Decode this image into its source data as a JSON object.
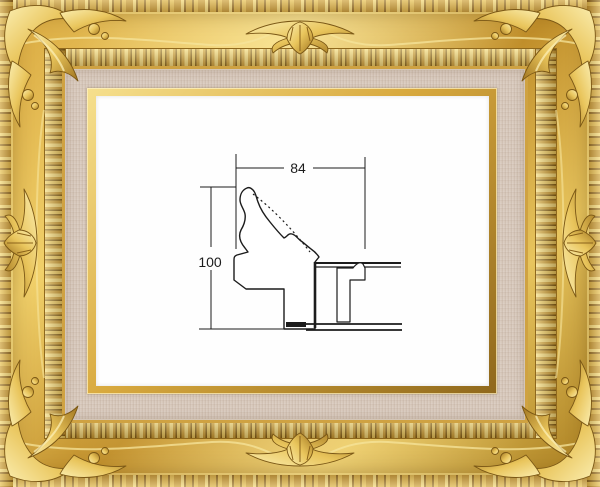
{
  "artwork": {
    "type": "frame-moulding-cross-section-diagram",
    "dimension_width_label": "84",
    "dimension_height_label": "100"
  },
  "frame": {
    "style": "ornate-baroque-gold-frame-with-linen-liner",
    "colors": {
      "gold_highlight": "#f6e08e",
      "gold_mid": "#cf9f38",
      "gold_shadow": "#7c5a16",
      "linen_liner": "#d7c8bb",
      "canvas_white": "#fefefe",
      "diagram_line": "#1c1c1c"
    }
  }
}
